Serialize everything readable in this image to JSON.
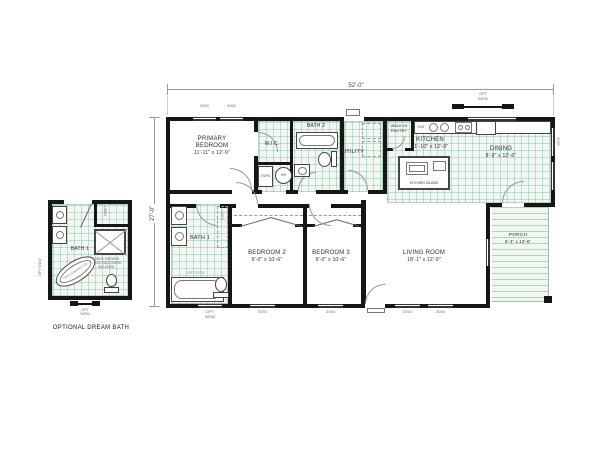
{
  "plan": {
    "dimensions": {
      "width": "52'-0\"",
      "depth": "27'-0\""
    },
    "rooms": {
      "primary_bedroom": {
        "name": "PRIMARY BEDROOM",
        "size": "11'-11\" x 12'-9\""
      },
      "wic": {
        "name": "W.I.C."
      },
      "bath2": {
        "name": "BATH 2"
      },
      "utility": {
        "name": "UTILITY"
      },
      "pantry": {
        "name": "WALK IN PANTRY"
      },
      "kitchen": {
        "name": "KITCHEN",
        "size": "11'-10\" x 12'-9\""
      },
      "dining": {
        "name": "DINING",
        "size": "8'-9\" x 12'-6\""
      },
      "bath1": {
        "name": "BATH 1"
      },
      "bedroom2": {
        "name": "BEDROOM 2",
        "size": "9'-0\" x 10'-6\""
      },
      "bedroom3": {
        "name": "BEDROOM 3",
        "size": "9'-0\" x 10'-6\""
      },
      "living_room": {
        "name": "LIVING ROOM",
        "size": "18'-1\" x 12'-9\""
      },
      "porch": {
        "name": "PORCH",
        "size": "5'-4\" x 13'-6\""
      }
    },
    "fixtures": {
      "furnace": "FURN",
      "water_heater": "WH",
      "dishwasher": "DW",
      "island": "KITCHEN ISLAND",
      "linen": "LINEN",
      "opt_storage": "OPT STOR"
    },
    "tags": {
      "window_size": "3050",
      "opt_line1": "OPT",
      "opt_line2": "WDW"
    }
  },
  "inset": {
    "room": "BATH 1",
    "linen": "LINEN",
    "tub": "FREESTANDING TUB",
    "note_line1": "LARGE SHOWER",
    "note_line2": "GLASS ENCLOSURE",
    "note_line3": "INCLUDED",
    "caption": "OPTIONAL DREAM BATH"
  },
  "colors": {
    "wall": "#161616",
    "tile": "#f1f8f3",
    "tile_grid": "#a7cdbb",
    "text": "#2b2b2b",
    "tag": "#777777"
  }
}
